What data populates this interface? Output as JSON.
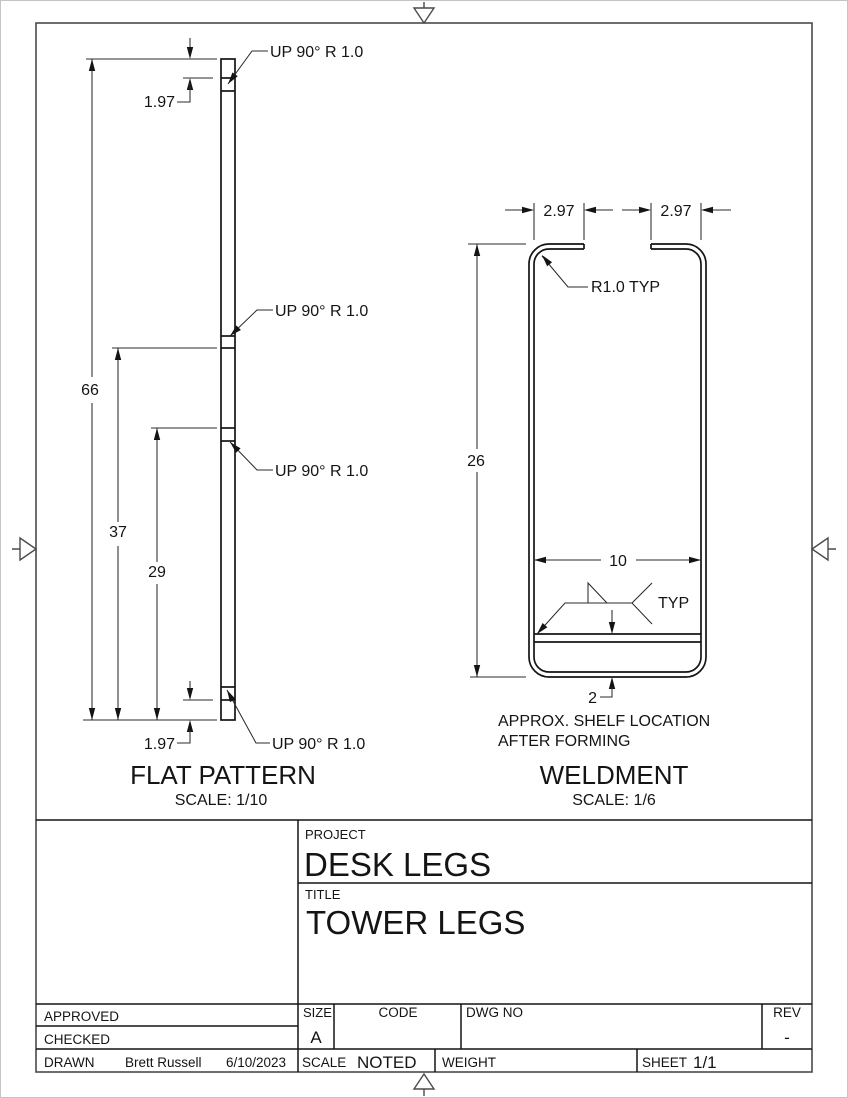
{
  "flat_pattern": {
    "title": "FLAT PATTERN",
    "scale": "SCALE: 1/10",
    "bend_callouts": [
      "UP 90° R 1.0",
      "UP 90° R 1.0",
      "UP 90° R 1.0",
      "UP 90° R 1.0"
    ],
    "dim_top_offset": "1.97",
    "dim_overall": "66",
    "dim_mid": "37",
    "dim_lower": "29",
    "dim_bottom_offset": "1.97"
  },
  "weldment": {
    "title": "WELDMENT",
    "scale": "SCALE: 1/6",
    "dim_flange_left": "2.97",
    "dim_flange_right": "2.97",
    "dim_height": "26",
    "dim_inner_width": "10",
    "dim_shelf_offset": "2",
    "radius_callout": "R1.0 TYP",
    "weld_typ": "TYP",
    "note_line1": "APPROX. SHELF LOCATION",
    "note_line2": "AFTER FORMING"
  },
  "title_block": {
    "project_label": "PROJECT",
    "project": "DESK LEGS",
    "title_label": "TITLE",
    "title": "TOWER LEGS",
    "approved_label": "APPROVED",
    "checked_label": "CHECKED",
    "drawn_label": "DRAWN",
    "drawn_by": "Brett Russell",
    "drawn_date": "6/10/2023",
    "size_label": "SIZE",
    "size": "A",
    "code_label": "CODE",
    "dwg_no_label": "DWG NO",
    "rev_label": "REV",
    "rev": "-",
    "scale_label": "SCALE",
    "scale_value": "NOTED",
    "weight_label": "WEIGHT",
    "sheet_label": "SHEET",
    "sheet": "1/1"
  }
}
